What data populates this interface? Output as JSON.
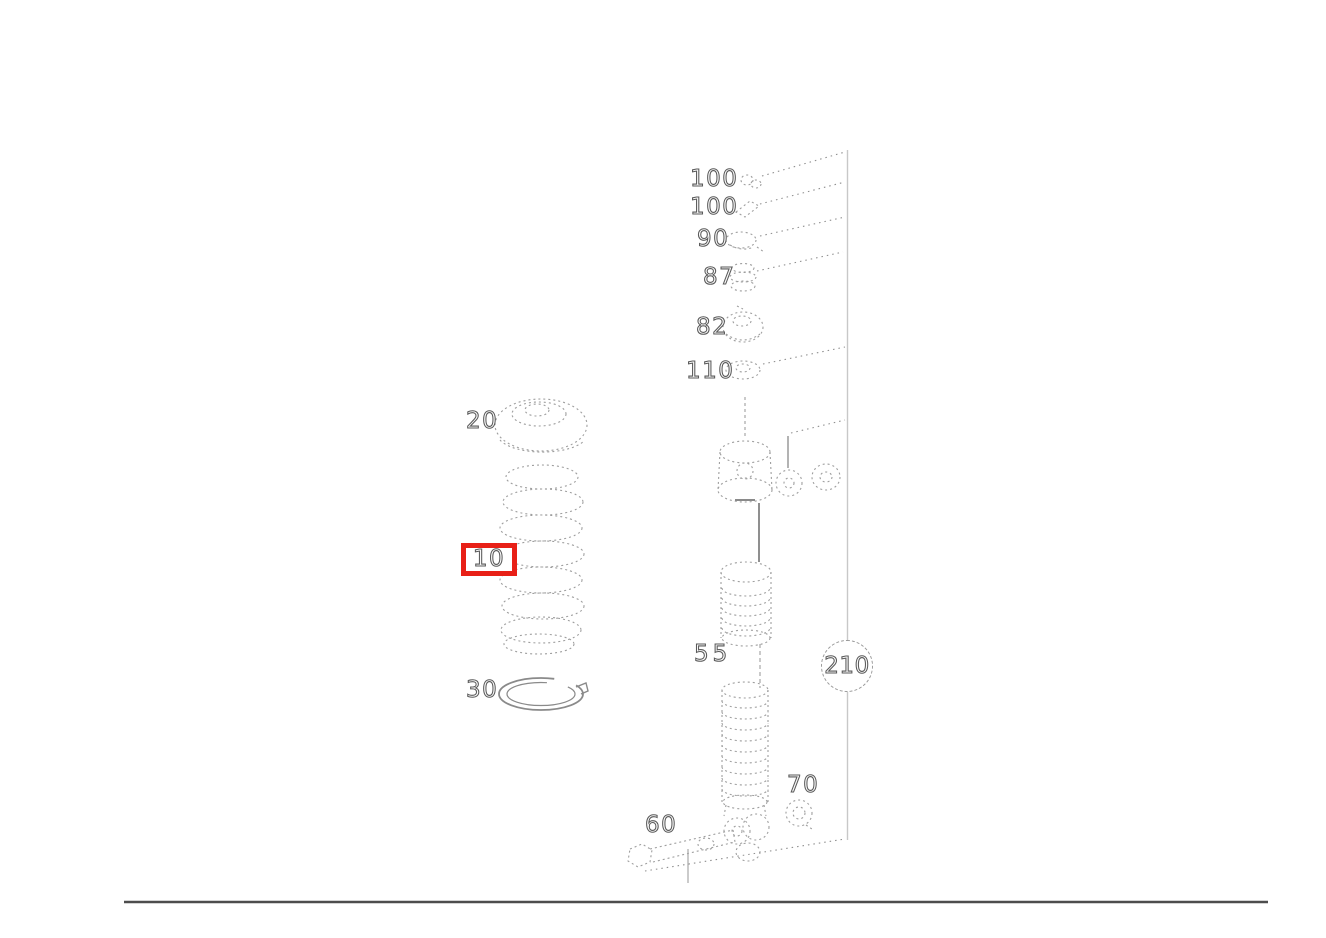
{
  "diagram": {
    "description": "exploded-parts-line-drawing",
    "colors": {
      "highlight": "#e82017",
      "sketch_line": "#9e9e9e",
      "solid_line": "#8a8a8a",
      "reference_line": "#c8c8c8",
      "footer_rule": "#4d4d4d",
      "label_text": "#5a5a5a"
    },
    "labels": [
      {
        "part": "100",
        "text": "100"
      },
      {
        "part": "100",
        "text": "100"
      },
      {
        "part": "90",
        "text": "90"
      },
      {
        "part": "87",
        "text": "87"
      },
      {
        "part": "82",
        "text": "82"
      },
      {
        "part": "110",
        "text": "110"
      },
      {
        "part": "20",
        "text": "20"
      },
      {
        "part": "10",
        "text": "10",
        "highlighted": true
      },
      {
        "part": "30",
        "text": "30"
      },
      {
        "part": "55",
        "text": "55"
      },
      {
        "part": "210",
        "text": "210",
        "circled": true
      },
      {
        "part": "70",
        "text": "70"
      },
      {
        "part": "60",
        "text": "60"
      }
    ]
  }
}
